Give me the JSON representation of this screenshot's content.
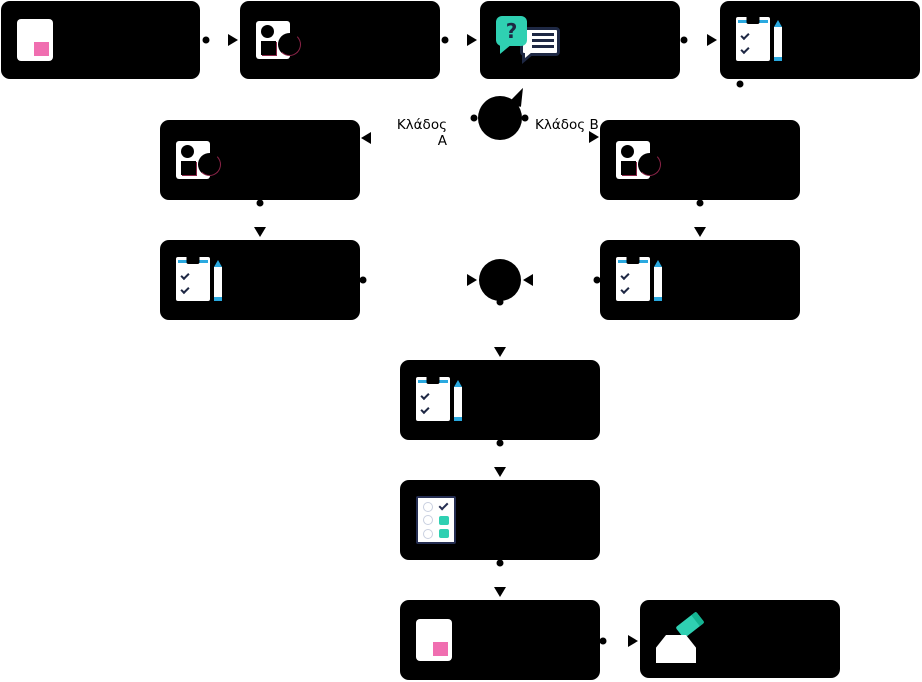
{
  "canvas": {
    "width": 922,
    "height": 682,
    "background": "#ffffff"
  },
  "palette": {
    "node_fill": "#000000",
    "pink": "#F06EB0",
    "teal": "#2FD0B2",
    "teal_dark": "#14B391",
    "navy": "#1E2844",
    "blue": "#2AA9E0",
    "red_accent": "#8B2347"
  },
  "labels": {
    "branch_a": "Κλάδος Α",
    "branch_b": "Κλάδος Β"
  },
  "glyphs": {
    "question_mark": "?"
  },
  "icon_names": [
    "card-icon",
    "person-icon",
    "chat-icon",
    "clipboard-icon",
    "checklist-icon",
    "ballot-icon"
  ],
  "nodes": [
    {
      "name": "node-start-card",
      "icon": "card-icon",
      "x": 1,
      "y": 1,
      "w": 199,
      "h": 78
    },
    {
      "name": "node-profile",
      "icon": "person-icon",
      "x": 240,
      "y": 1,
      "w": 200,
      "h": 78
    },
    {
      "name": "node-question-chat",
      "icon": "chat-icon",
      "x": 480,
      "y": 1,
      "w": 200,
      "h": 78
    },
    {
      "name": "node-form",
      "icon": "clipboard-icon",
      "x": 720,
      "y": 1,
      "w": 200,
      "h": 78
    },
    {
      "name": "node-branch-a-profile",
      "icon": "person-icon",
      "x": 160,
      "y": 120,
      "w": 200,
      "h": 80
    },
    {
      "name": "node-branch-b-profile",
      "icon": "person-icon",
      "x": 600,
      "y": 120,
      "w": 200,
      "h": 80
    },
    {
      "name": "node-branch-a-form",
      "icon": "clipboard-icon",
      "x": 160,
      "y": 240,
      "w": 200,
      "h": 80
    },
    {
      "name": "node-branch-b-form",
      "icon": "clipboard-icon",
      "x": 600,
      "y": 240,
      "w": 200,
      "h": 80
    },
    {
      "name": "node-merged-form",
      "icon": "clipboard-icon",
      "x": 400,
      "y": 360,
      "w": 200,
      "h": 80
    },
    {
      "name": "node-checklist",
      "icon": "checklist-icon",
      "x": 400,
      "y": 480,
      "w": 200,
      "h": 80
    },
    {
      "name": "node-result-card",
      "icon": "card-icon",
      "x": 400,
      "y": 600,
      "w": 200,
      "h": 80
    },
    {
      "name": "node-submit-ballot",
      "icon": "ballot-icon",
      "x": 640,
      "y": 600,
      "w": 200,
      "h": 78
    }
  ],
  "circles": [
    {
      "name": "decision-node",
      "x": 478,
      "y": 96,
      "d": 44,
      "tail": true
    },
    {
      "name": "merge-node",
      "x": 479,
      "y": 259,
      "d": 42,
      "tail": false
    }
  ],
  "dots": [
    {
      "x": 206,
      "y": 40
    },
    {
      "x": 445,
      "y": 40
    },
    {
      "x": 684,
      "y": 40
    },
    {
      "x": 740,
      "y": 84
    },
    {
      "x": 474,
      "y": 118
    },
    {
      "x": 525,
      "y": 118
    },
    {
      "x": 260,
      "y": 203
    },
    {
      "x": 700,
      "y": 203
    },
    {
      "x": 363,
      "y": 280
    },
    {
      "x": 597,
      "y": 280
    },
    {
      "x": 500,
      "y": 302
    },
    {
      "x": 500,
      "y": 443
    },
    {
      "x": 500,
      "y": 563
    },
    {
      "x": 603,
      "y": 641
    }
  ],
  "arrows": [
    {
      "x": 238,
      "y": 40,
      "dir": "right"
    },
    {
      "x": 477,
      "y": 40,
      "dir": "right"
    },
    {
      "x": 717,
      "y": 40,
      "dir": "right"
    },
    {
      "x": 361,
      "y": 138,
      "dir": "left"
    },
    {
      "x": 599,
      "y": 137,
      "dir": "right"
    },
    {
      "x": 260,
      "y": 237,
      "dir": "down"
    },
    {
      "x": 700,
      "y": 237,
      "dir": "down"
    },
    {
      "x": 477,
      "y": 280,
      "dir": "right"
    },
    {
      "x": 523,
      "y": 280,
      "dir": "left"
    },
    {
      "x": 500,
      "y": 357,
      "dir": "down"
    },
    {
      "x": 500,
      "y": 477,
      "dir": "down"
    },
    {
      "x": 500,
      "y": 597,
      "dir": "down"
    },
    {
      "x": 638,
      "y": 641,
      "dir": "right"
    }
  ]
}
